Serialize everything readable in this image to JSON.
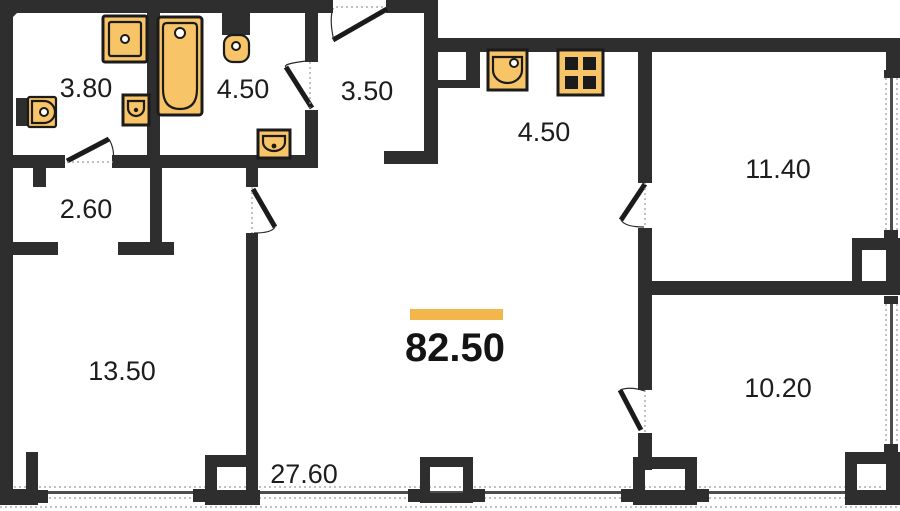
{
  "plan": {
    "type": "apartment-floor-plan",
    "total": {
      "area": "82.50"
    },
    "rooms": [
      {
        "name": "bathroom-left",
        "area": "3.80"
      },
      {
        "name": "bathroom-with-tub",
        "area": "4.50"
      },
      {
        "name": "entry-hallway",
        "area": "3.50"
      },
      {
        "name": "kitchen",
        "area": "4.50"
      },
      {
        "name": "bedroom-top-right",
        "area": "11.40"
      },
      {
        "name": "storage-closet",
        "area": "2.60"
      },
      {
        "name": "room-bottom-left",
        "area": "13.50"
      },
      {
        "name": "living-room",
        "area": "27.60"
      },
      {
        "name": "bedroom-bottom-right",
        "area": "10.20"
      }
    ],
    "fixtures": [
      "washing-machine",
      "bathtub",
      "toilet",
      "wall-sink",
      "corner-sink",
      "vanity-sink",
      "kitchen-sink",
      "stove"
    ],
    "colors": {
      "wall": "#2e2e2e",
      "fixture": "#f8c468",
      "accent": "#f2b64d",
      "ink": "#1d1d1d",
      "glass": "#4d4d4d",
      "dots": "#9a9a9a"
    }
  }
}
